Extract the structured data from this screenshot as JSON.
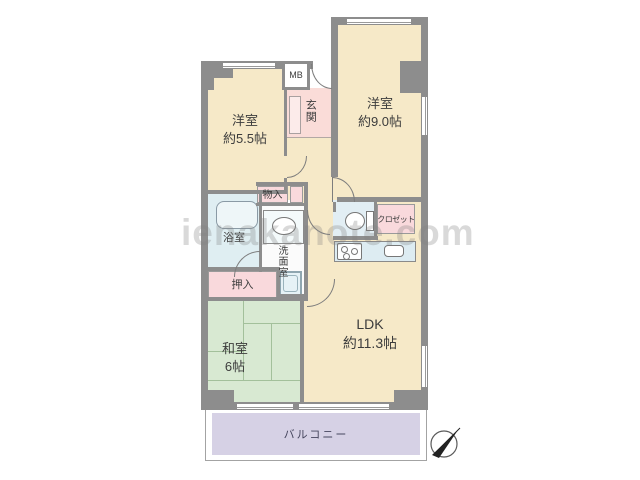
{
  "plan_title": "マンション間取り図 3LDK",
  "watermark": "ienakanote.com",
  "rooms": {
    "western_room_small": {
      "name": "洋室",
      "size": "約5.5帖"
    },
    "western_room_large": {
      "name": "洋室",
      "size": "約9.0帖"
    },
    "ldk": {
      "name": "LDK",
      "size": "約11.3帖"
    },
    "japanese_room": {
      "name": "和室",
      "size": "6帖"
    },
    "entrance": {
      "name": "玄関"
    },
    "bathroom": {
      "name": "浴室"
    },
    "washroom": {
      "name": "洗面室"
    },
    "storage_monoire": {
      "name": "物入"
    },
    "storage_oshiire": {
      "name": "押入"
    },
    "closet": {
      "name": "クロゼット"
    },
    "meter_box": {
      "name": "MB"
    },
    "balcony": {
      "name": "バルコニー"
    }
  },
  "colors": {
    "room_beige": "#f6e9c8",
    "room_green": "#d8e9d2",
    "storage_pink": "#f9d9dc",
    "entrance_pink": "#fadcd8",
    "shoe_cabinet_pink": "#fcebea",
    "water_blue": "#dfeef2",
    "toilet_blue": "#e2eef4",
    "kitchen_blue": "#ddecf2",
    "balcony_purple": "#d6d1e5",
    "wall_gray": "#8d8d8d"
  }
}
